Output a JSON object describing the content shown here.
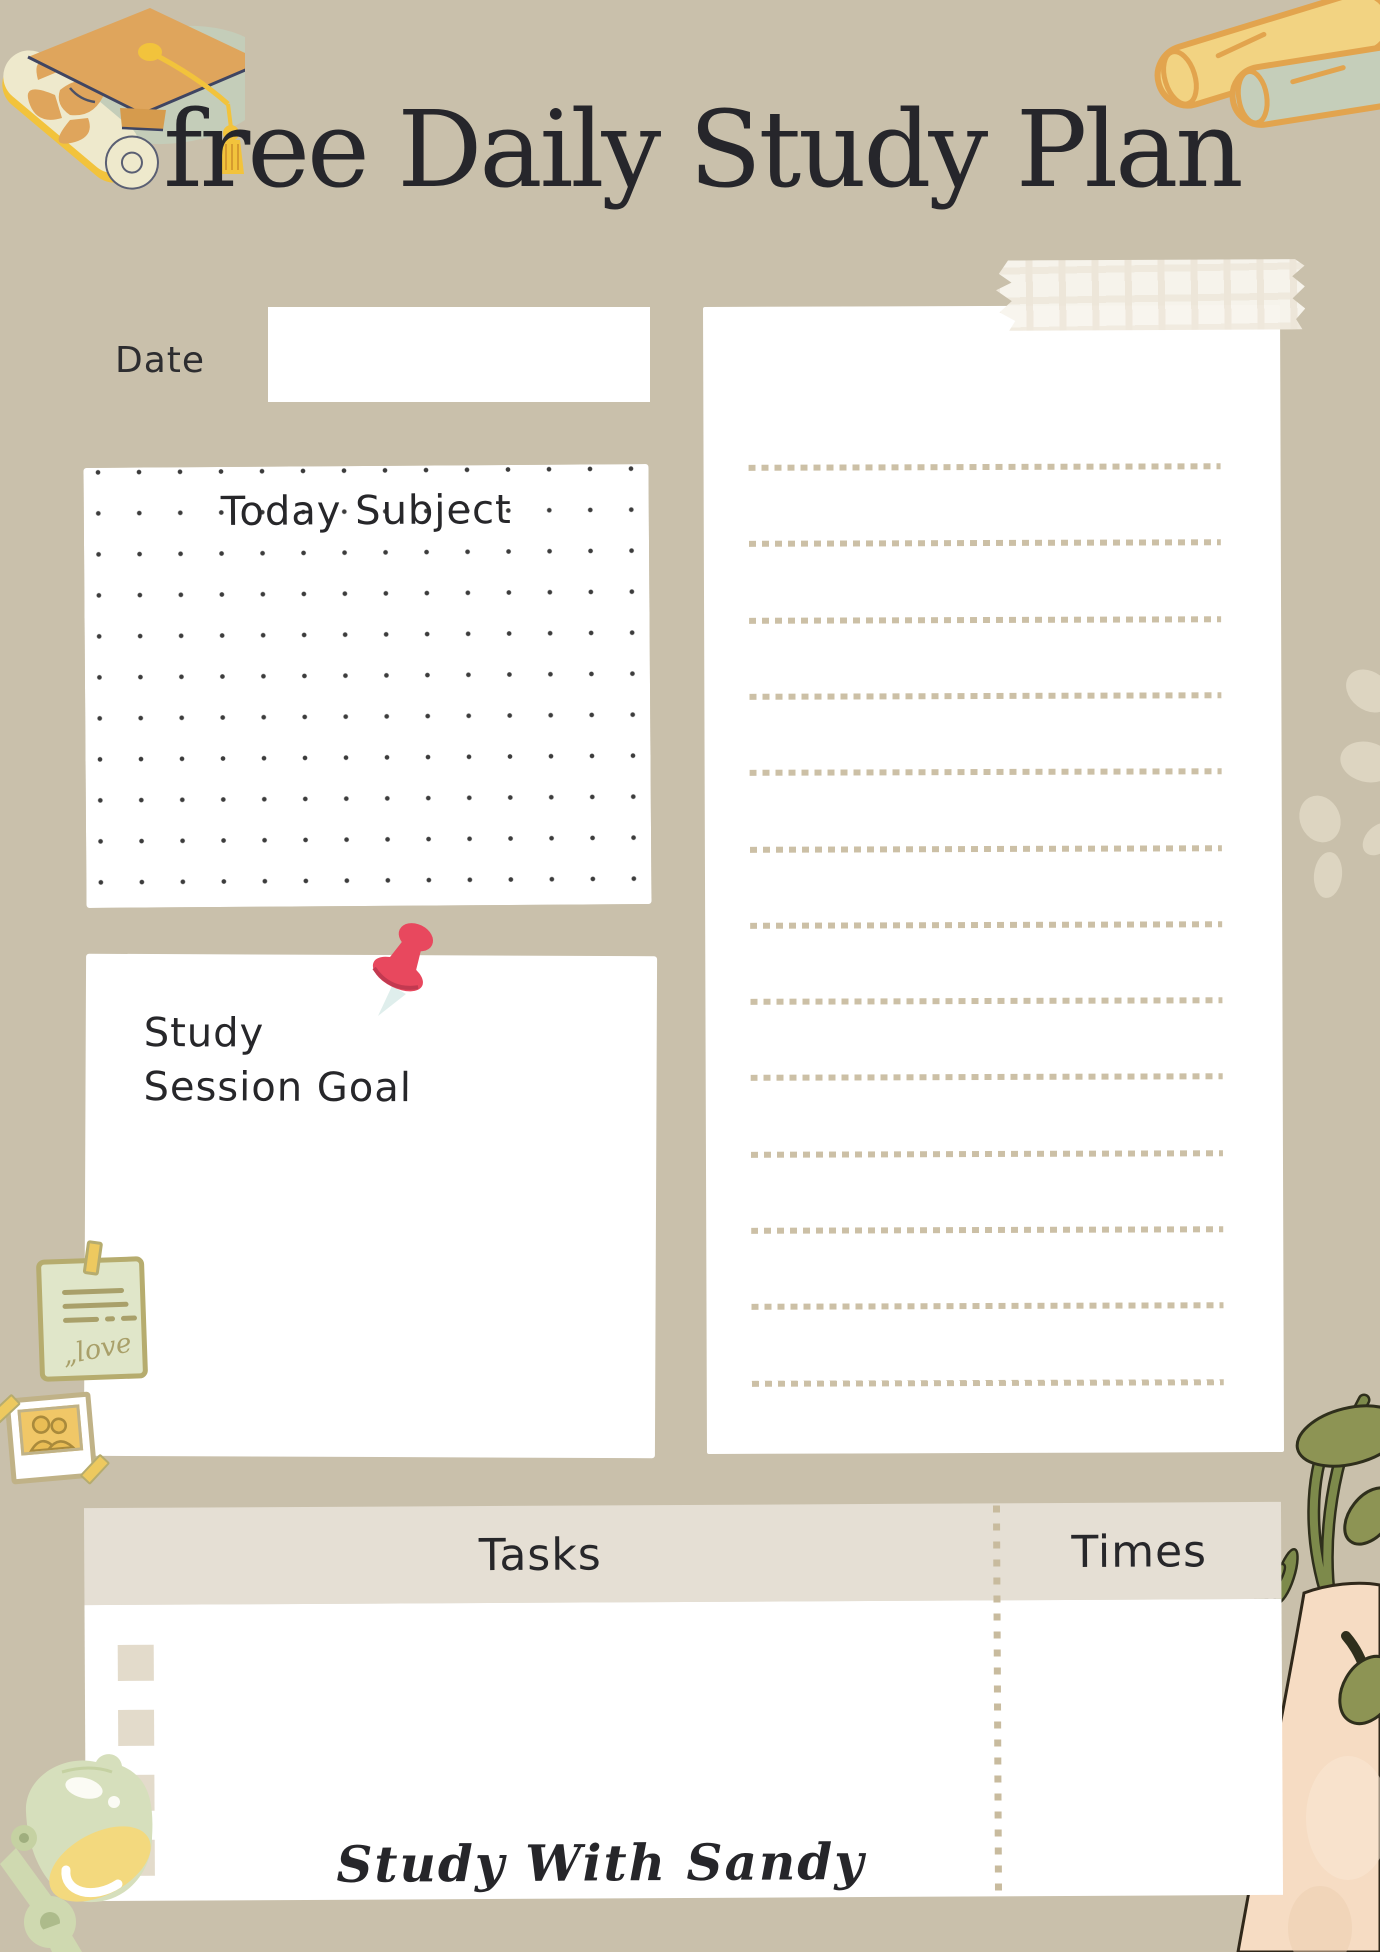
{
  "header": {
    "title": "free Daily Study Plan"
  },
  "date_section": {
    "label": "Date",
    "value": ""
  },
  "subject_section": {
    "label": "Today Subject",
    "value": ""
  },
  "goal_section": {
    "label_line1": "Study",
    "label_line2": "Session Goal",
    "value": ""
  },
  "notes_section": {
    "line_count": 13,
    "value": ""
  },
  "tasks_section": {
    "tasks_header": "Tasks",
    "times_header": "Times",
    "row_count": 4,
    "rows": []
  },
  "footer": {
    "brand": "Study With Sandy"
  },
  "decorations": {
    "sticky_note": {
      "mark": "„",
      "text": "love"
    },
    "icons": [
      "graduation-cap",
      "paper-scrolls",
      "washi-tape",
      "push-pin",
      "sticky-note",
      "polaroid-photo",
      "desk-lamp",
      "potted-plant",
      "blob-accents"
    ]
  },
  "colors": {
    "background": "#c9c0ab",
    "panel_white": "#ffffff",
    "header_band": "#e5dfd4",
    "checkbox_beige": "#e3dbcb",
    "dash_beige": "#ccc0a6",
    "text_dark": "#26262b",
    "accent_red": "#e8485e",
    "accent_yellow": "#f2c33c",
    "accent_orange": "#dfa55c",
    "accent_sage": "#c4cdb9",
    "accent_green": "#8d9454",
    "pot_peach": "#f6dcc3"
  }
}
